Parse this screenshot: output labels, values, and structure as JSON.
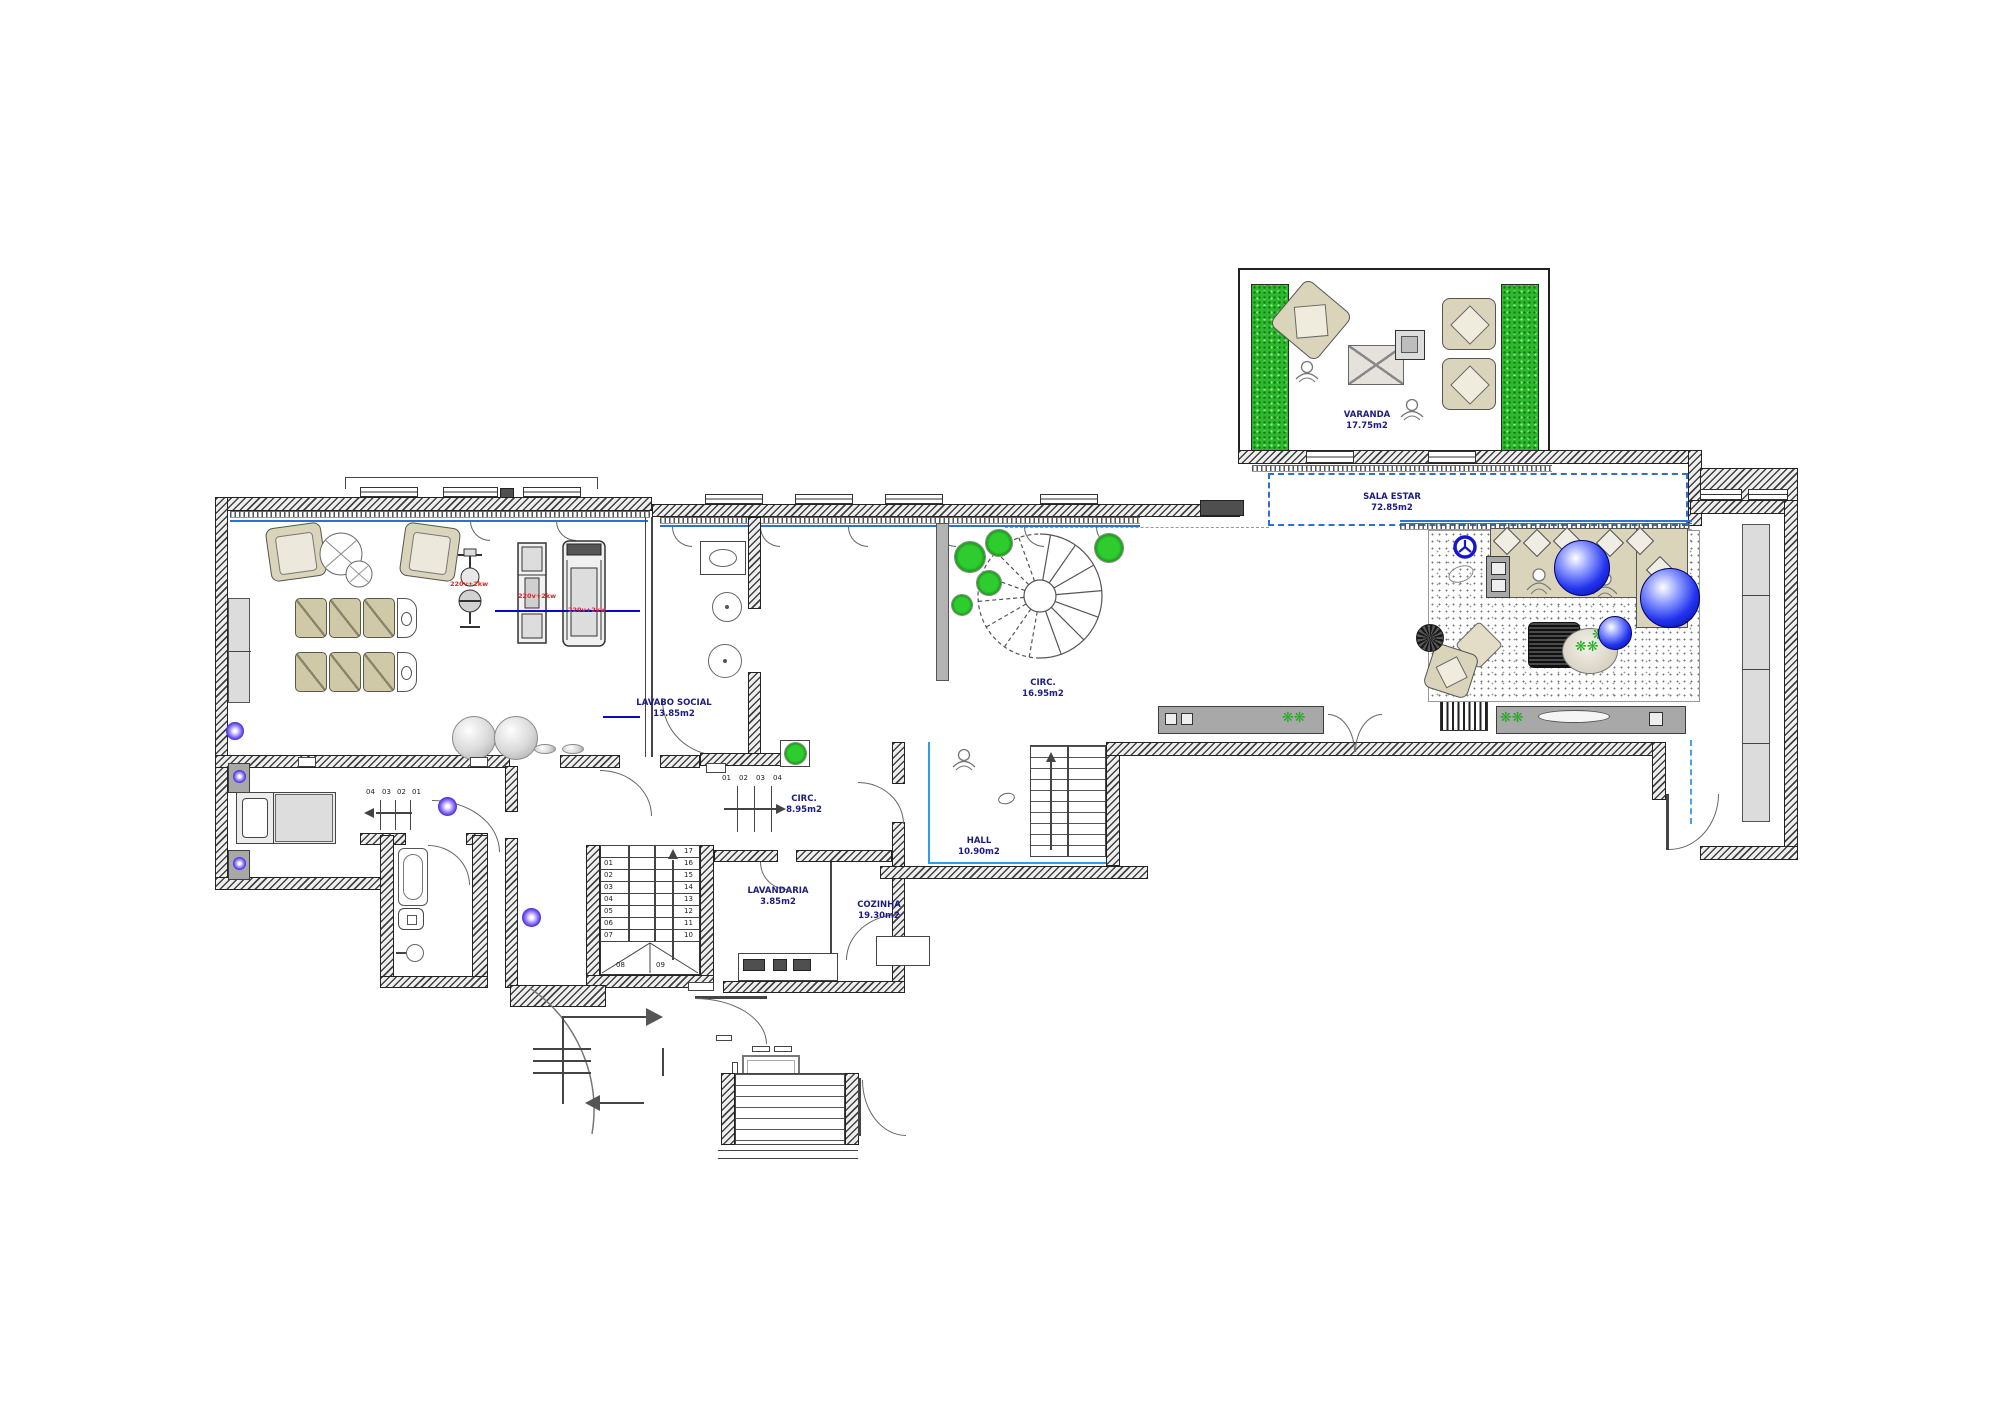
{
  "plan": {
    "rooms": {
      "varanda": {
        "name": "VARANDA",
        "area": "17.75m2"
      },
      "sala_estar": {
        "name": "SALA ESTAR",
        "area": "72.85m2"
      },
      "lavabo_social": {
        "name": "LAVABO SOCIAL",
        "area": "13.85m2"
      },
      "circ_spiral": {
        "name": "CIRC.",
        "area": "16.95m2"
      },
      "circ_hall": {
        "name": "CIRC.",
        "area": "8.95m2"
      },
      "hall": {
        "name": "HALL",
        "area": "10.90m2"
      },
      "lavandaria": {
        "name": "LAVANDARIA",
        "area": "3.85m2"
      },
      "cozinha": {
        "name": "COZINHA",
        "area": "19.30m2"
      }
    },
    "stairs": {
      "main_left": [
        "01",
        "02",
        "03",
        "04",
        "05",
        "06",
        "07"
      ],
      "main_right": [
        "17",
        "16",
        "15",
        "14",
        "13",
        "12",
        "11",
        "10"
      ],
      "main_bottom": [
        "08",
        "09"
      ],
      "circ_steps": [
        "01",
        "02",
        "03",
        "04"
      ],
      "bedroom_steps": [
        "04",
        "03",
        "02",
        "01"
      ]
    },
    "equipment_power": [
      "220v+2kw",
      "220v+2kw",
      "220v+2kw"
    ],
    "icons": {
      "plant_glyph": "❋",
      "plant_pair": "❋❋"
    },
    "colors": {
      "label_navy": "#1c1c80",
      "power_red": "#e02525",
      "plant_green": "#1fae1f",
      "window_blue": "#2f6fd0",
      "hall_blue": "#2f9fe0",
      "sphere_blue": "#2233ee",
      "beige": "#d9d4ba",
      "console_gray": "#a8a8a8"
    }
  }
}
